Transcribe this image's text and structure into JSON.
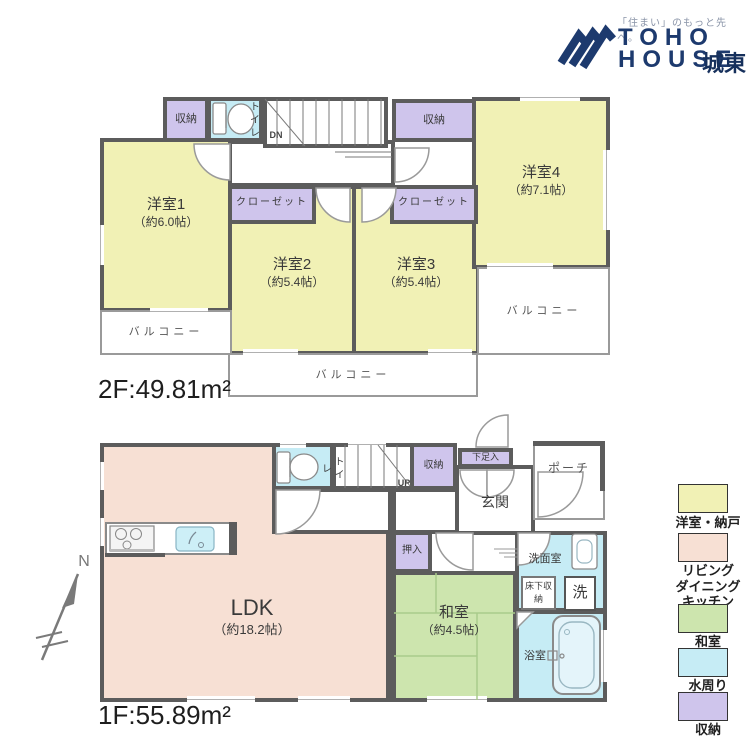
{
  "logo": {
    "tagline": "「住まい」のもっと先へ。",
    "brand_top": "TOHO",
    "brand_bottom": "HOUSE",
    "branch": "城東"
  },
  "compass": {
    "north": "N"
  },
  "floor2": {
    "area": "2F:49.81m²",
    "stairs": "DN",
    "balcony": "バルコニー",
    "storage": "収納",
    "toilet": "トイレ",
    "closet": "クローゼット",
    "rooms": {
      "r1": {
        "name": "洋室1",
        "size": "（約6.0帖）"
      },
      "r2": {
        "name": "洋室2",
        "size": "（約5.4帖）"
      },
      "r3": {
        "name": "洋室3",
        "size": "（約5.4帖）"
      },
      "r4": {
        "name": "洋室4",
        "size": "（約7.1帖）"
      }
    }
  },
  "floor1": {
    "area": "1F:55.89m²",
    "stairs": "UP",
    "toilet": "トイレ",
    "storage": "収納",
    "shoe_box": "下足入",
    "entrance": "玄関",
    "porch": "ポーチ",
    "oshiire": "押入",
    "ldk": {
      "name": "LDK",
      "size": "（約18.2帖）"
    },
    "washitsu": {
      "name": "和室",
      "size": "（約4.5帖）"
    },
    "washroom": "洗面室",
    "underfloor_storage": "床下収納",
    "washer": "洗",
    "bathroom": "浴室"
  },
  "legend": {
    "items": [
      {
        "label": "洋室・納戸",
        "color": "#f1f1b5"
      },
      {
        "label": "リビング\nダイニング\nキッチン",
        "color": "#f7e0d4"
      },
      {
        "label": "和室",
        "color": "#cde5ae"
      },
      {
        "label": "水周り",
        "color": "#c6ecf5"
      },
      {
        "label": "収納",
        "color": "#cfc5ec"
      }
    ]
  },
  "colors": {
    "wall": "#5c5c5c",
    "western_room": "#f1f1b5",
    "ldk": "#f7e0d4",
    "tatami": "#cde5ae",
    "water": "#c6ecf5",
    "storage": "#cfc5ec",
    "brand_navy": "#1d3a6e"
  }
}
